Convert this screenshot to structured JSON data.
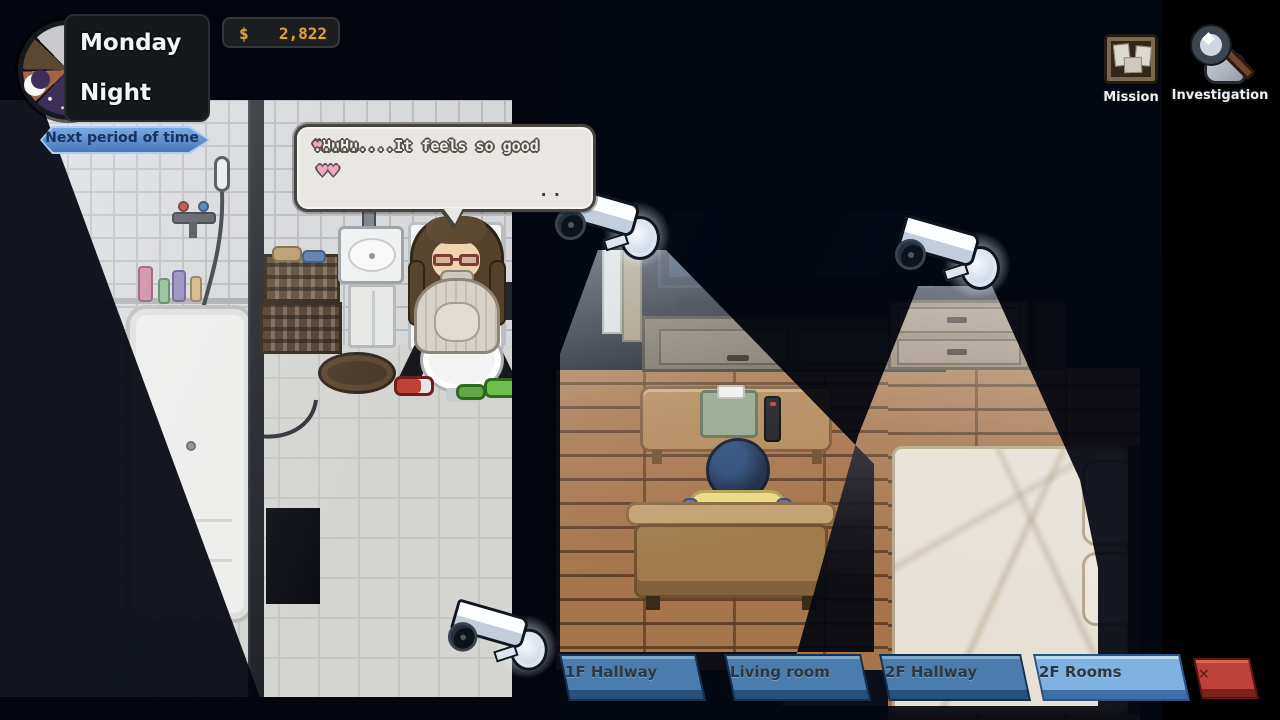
{
  "hud": {
    "day": "Monday",
    "period": "Night",
    "next_period_button": "Next period of time",
    "money": {
      "symbol": "$",
      "amount": "2,822"
    },
    "mission_label": "Mission",
    "investigation_label": "Investigation"
  },
  "dialogue": {
    "line1_text": "\"HuHu....It feels so good ",
    "line1_heart": "♥",
    "line1_dots": " .......",
    "line2_hearts": "♥♥",
    "continue_indicator": ".."
  },
  "camera_tabs": {
    "tabs": [
      {
        "label": "1F Hallway",
        "active": false
      },
      {
        "label": "Living room",
        "active": false
      },
      {
        "label": "2F Hallway",
        "active": false
      },
      {
        "label": "2F Rooms",
        "active": true
      }
    ],
    "close_button": "✕"
  },
  "colors": {
    "money_gold": "#d9a53f",
    "heart_pink": "#f2a6c4",
    "next_button_blue": "#5e8fd0",
    "tab_inactive": "#4a7dad",
    "tab_active": "#7fb2e0",
    "close_red": "#bc4237",
    "beam_white": "#e9f1fb",
    "night_purple": "#3e2f5a"
  }
}
